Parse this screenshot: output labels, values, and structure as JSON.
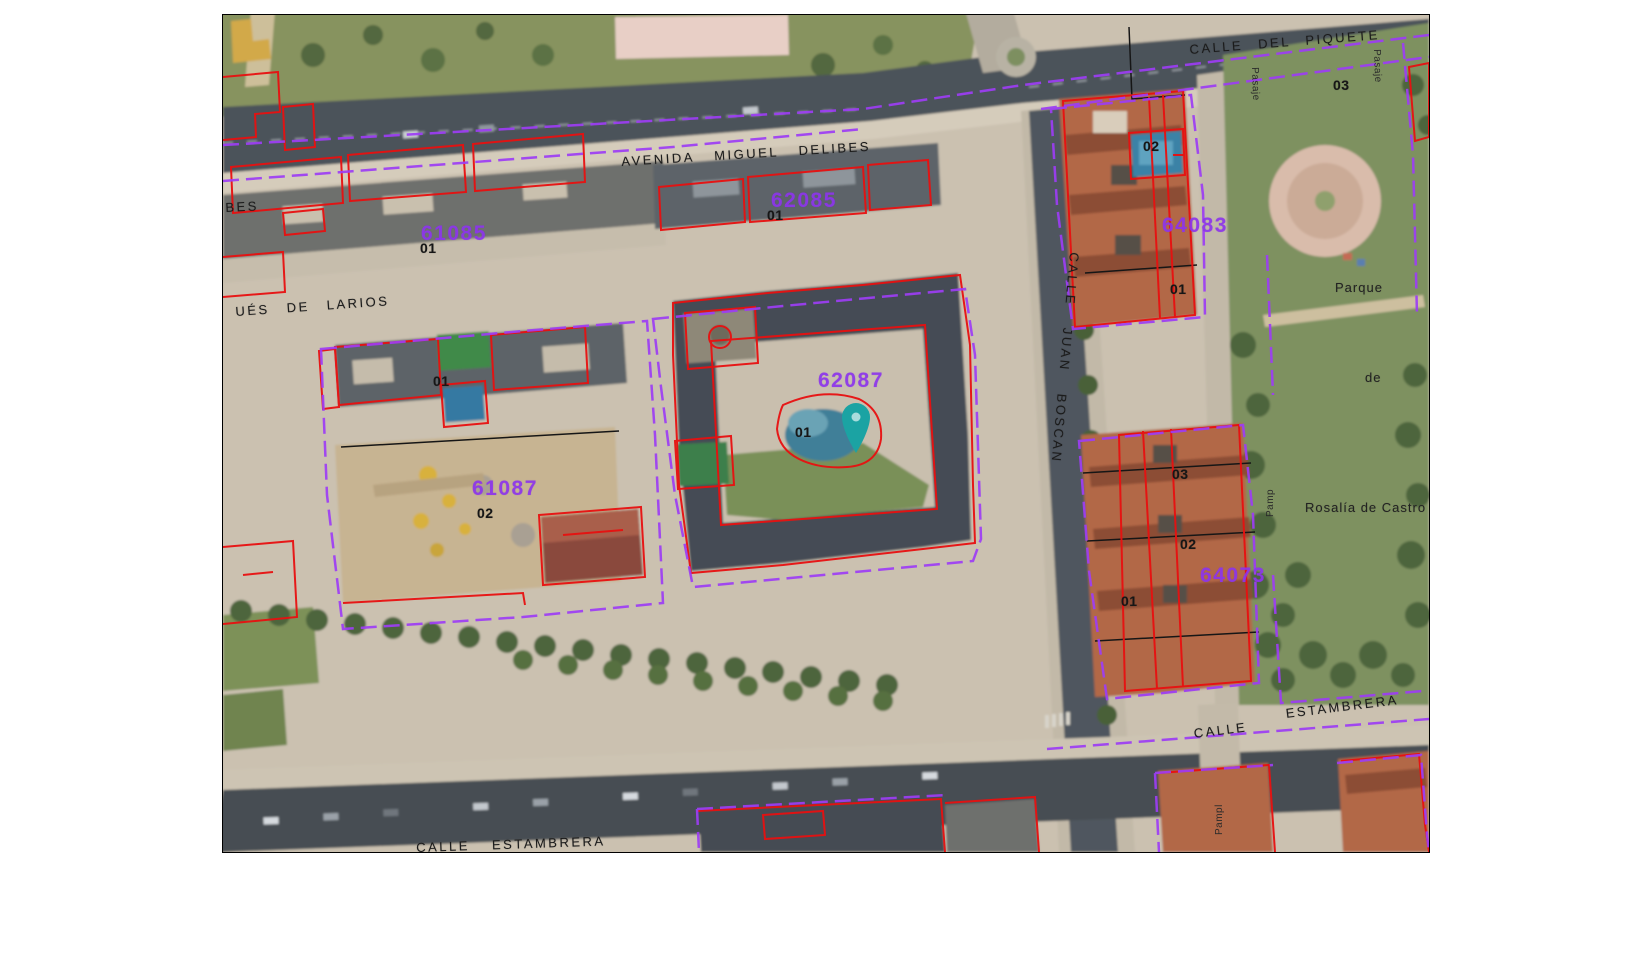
{
  "app": {
    "type": "cadastral-map-viewer"
  },
  "palette": {
    "page_bg": "#ffffff",
    "map_border": "#000000",
    "cadastral_red": "#e81010",
    "block_purple": "#9d3df5",
    "parcel_black": "#161616",
    "block_code_purple": "#8d35ec",
    "street_text": "#1b1b1b",
    "pin_teal": "#1ba3a3",
    "pin_hole": "#a8dcdc"
  },
  "map": {
    "street_labels": [
      {
        "text": "CALLE  DEL  PIQUETE",
        "x": 966,
        "y": 28,
        "rot": -4.5,
        "name": "street-label-calle-del-piquete"
      },
      {
        "text": "AVENIDA   MIGUEL   DELIBES",
        "x": 398,
        "y": 140,
        "rot": -3.5,
        "ws": 14,
        "name": "street-label-avenida-miguel-delibes"
      },
      {
        "text": "BES",
        "x": 2,
        "y": 186,
        "rot": -3,
        "name": "street-label-delibes-fragment"
      },
      {
        "text": "UÉS  DE  LARIOS",
        "x": 12,
        "y": 290,
        "rot": -4,
        "ws": 11,
        "name": "street-label-marques-de-larios"
      },
      {
        "text": "CALLE   JUAN   BOSCAN",
        "x": 858,
        "y": 238,
        "rot": 95,
        "ws": 16,
        "name": "street-label-calle-juan-boscan"
      },
      {
        "text": "CALLE",
        "x": 970,
        "y": 712,
        "rot": -7,
        "name": "street-label-calle-estambrera-right-1"
      },
      {
        "text": "ESTAMBRERA",
        "x": 1062,
        "y": 692,
        "rot": -7,
        "name": "street-label-calle-estambrera-right-2"
      },
      {
        "text": "CALLE    ESTAMBRERA",
        "x": 193,
        "y": 826,
        "rot": -2,
        "ws": 16,
        "name": "street-label-calle-estambrera-left"
      }
    ],
    "park_labels": [
      {
        "text": "Parque",
        "x": 1112,
        "y": 266,
        "name": "park-label-parque"
      },
      {
        "text": "de",
        "x": 1142,
        "y": 356,
        "name": "park-label-de"
      },
      {
        "text": "Rosalía de Castro",
        "x": 1082,
        "y": 486,
        "name": "park-label-rosalia-de-castro"
      }
    ],
    "passage_labels": [
      {
        "text": "Pasaje",
        "x": 1036,
        "y": 52,
        "rot": 88,
        "name": "passage-label-pasaje-1"
      },
      {
        "text": "Pasaje",
        "x": 1158,
        "y": 34,
        "rot": 88,
        "name": "passage-label-pasaje-2"
      },
      {
        "text": "Pamp",
        "x": 1043,
        "y": 502,
        "rot": -90,
        "name": "passage-label-pamplona-1"
      },
      {
        "text": "Pampl",
        "x": 992,
        "y": 820,
        "rot": -90,
        "name": "passage-label-pamplona-2"
      }
    ],
    "block_codes": [
      {
        "text": "61085",
        "x": 198,
        "y": 208,
        "name": "block-code-61085"
      },
      {
        "text": "62085",
        "x": 548,
        "y": 175,
        "name": "block-code-62085"
      },
      {
        "text": "61087",
        "x": 249,
        "y": 463,
        "name": "block-code-61087"
      },
      {
        "text": "62087",
        "x": 595,
        "y": 355,
        "name": "block-code-62087"
      },
      {
        "text": "64083",
        "x": 939,
        "y": 200,
        "name": "block-code-64083"
      },
      {
        "text": "64073",
        "x": 977,
        "y": 550,
        "name": "block-code-64073"
      }
    ],
    "unit_numbers": [
      {
        "text": "01",
        "x": 544,
        "y": 193,
        "name": "unit-number"
      },
      {
        "text": "01",
        "x": 197,
        "y": 226,
        "name": "unit-number"
      },
      {
        "text": "01",
        "x": 210,
        "y": 359,
        "name": "unit-number"
      },
      {
        "text": "01",
        "x": 572,
        "y": 410,
        "name": "unit-number"
      },
      {
        "text": "02",
        "x": 254,
        "y": 491,
        "name": "unit-number"
      },
      {
        "text": "02",
        "x": 920,
        "y": 124,
        "name": "unit-number"
      },
      {
        "text": "01",
        "x": 947,
        "y": 267,
        "name": "unit-number"
      },
      {
        "text": "03",
        "x": 1110,
        "y": 63,
        "name": "unit-number"
      },
      {
        "text": "03",
        "x": 949,
        "y": 452,
        "name": "unit-number"
      },
      {
        "text": "02",
        "x": 957,
        "y": 522,
        "name": "unit-number"
      },
      {
        "text": "01",
        "x": 898,
        "y": 579,
        "name": "unit-number"
      }
    ],
    "pin": {
      "x": 613,
      "y": 386,
      "color": "#1ba3a3",
      "hole": "#a8dcdc"
    }
  }
}
